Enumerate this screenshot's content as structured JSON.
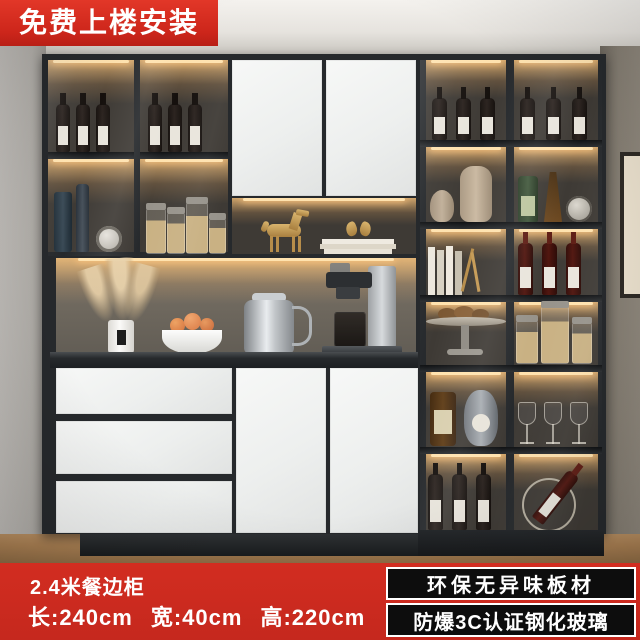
{
  "top_banner": {
    "label": "免费上楼安装"
  },
  "product": {
    "title": "2.4米餐边柜",
    "dim_length": "长:240cm",
    "dim_width": "宽:40cm",
    "dim_height": "高:220cm"
  },
  "features": [
    {
      "label": "环保无异味板材"
    },
    {
      "label": "防爆3C认证钢化玻璃"
    }
  ],
  "colors": {
    "banner_red": "#cd281d",
    "feature_bg": "#0d0d0d",
    "feature_border": "#ffffff",
    "cabinet_dark": "#26292c",
    "door_white": "#f0f1f0",
    "led_warm": "#ffc87e"
  }
}
